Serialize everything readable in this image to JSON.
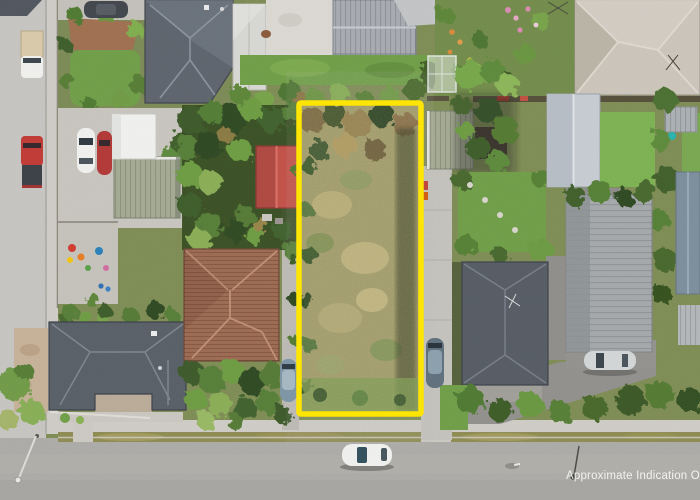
{
  "image": {
    "kind": "aerial-photograph",
    "subject": "suburban properties with a highlighted vacant section outlined in yellow"
  },
  "watermark": {
    "text": "Approximate Indication O"
  },
  "palette": {
    "boundary_yellow": "#ffe600",
    "road_light": "#c6c5c1",
    "street_asphalt": "#acaba7",
    "footpath": "#cfccc6",
    "grass_berm": "#8e8c52",
    "lawn_green": "#6f9e47",
    "lawn_bright": "#7cb252",
    "meadow_base": "#a29c68",
    "roof_dark_gray": "#5d646d",
    "roof_light_gray": "#a7abb1",
    "roof_beige": "#cbc5ba",
    "roof_pale_blue": "#c6ccd2",
    "roof_terracotta": "#9c6a52",
    "roof_red_shed": "#c25148",
    "roof_sage_green": "#a4aa93",
    "roof_ribbed_gray": "#a5a8ab",
    "concrete_drive": "#c4c2bc",
    "car_white": "#f0f1ee",
    "car_red": "#c13a34",
    "car_dark": "#41454c",
    "car_blue_gray": "#7d95a5",
    "car_silver": "#d3d6d6",
    "dirt_tan": "#c6b198",
    "watermark_color": "rgba(255,255,255,0.85)"
  },
  "scene_objects": [
    {
      "name": "highlighted-vacant-lot",
      "type": "property-boundary-overlay",
      "color": "#ffe600"
    },
    {
      "name": "white-car-street",
      "type": "car"
    },
    {
      "name": "silver-car-driveway",
      "type": "car"
    },
    {
      "name": "blue-gray-car-left-strip",
      "type": "car"
    },
    {
      "name": "blue-gray-car-right-strip",
      "type": "car"
    },
    {
      "name": "white-ute-roadside",
      "type": "vehicle"
    },
    {
      "name": "red-ute-roadside",
      "type": "vehicle"
    },
    {
      "name": "dark-car-top-left",
      "type": "car"
    },
    {
      "name": "white-box-truck",
      "type": "truck"
    },
    {
      "name": "white-car-driveway",
      "type": "car"
    },
    {
      "name": "red-car-driveway",
      "type": "car"
    },
    {
      "name": "red-roof-shed",
      "type": "building"
    },
    {
      "name": "terracotta-tile-house",
      "type": "building"
    },
    {
      "name": "dark-hip-house-southwest",
      "type": "building"
    },
    {
      "name": "dark-hip-house-northwest",
      "type": "building"
    },
    {
      "name": "beige-hip-house-northeast",
      "type": "building"
    },
    {
      "name": "pale-gable-house-east",
      "type": "building"
    },
    {
      "name": "sage-green-garage-west",
      "type": "building"
    },
    {
      "name": "sage-green-garage-east",
      "type": "building"
    },
    {
      "name": "ribbed-gray-garage-east",
      "type": "building"
    },
    {
      "name": "dark-hip-house-east",
      "type": "building"
    }
  ]
}
